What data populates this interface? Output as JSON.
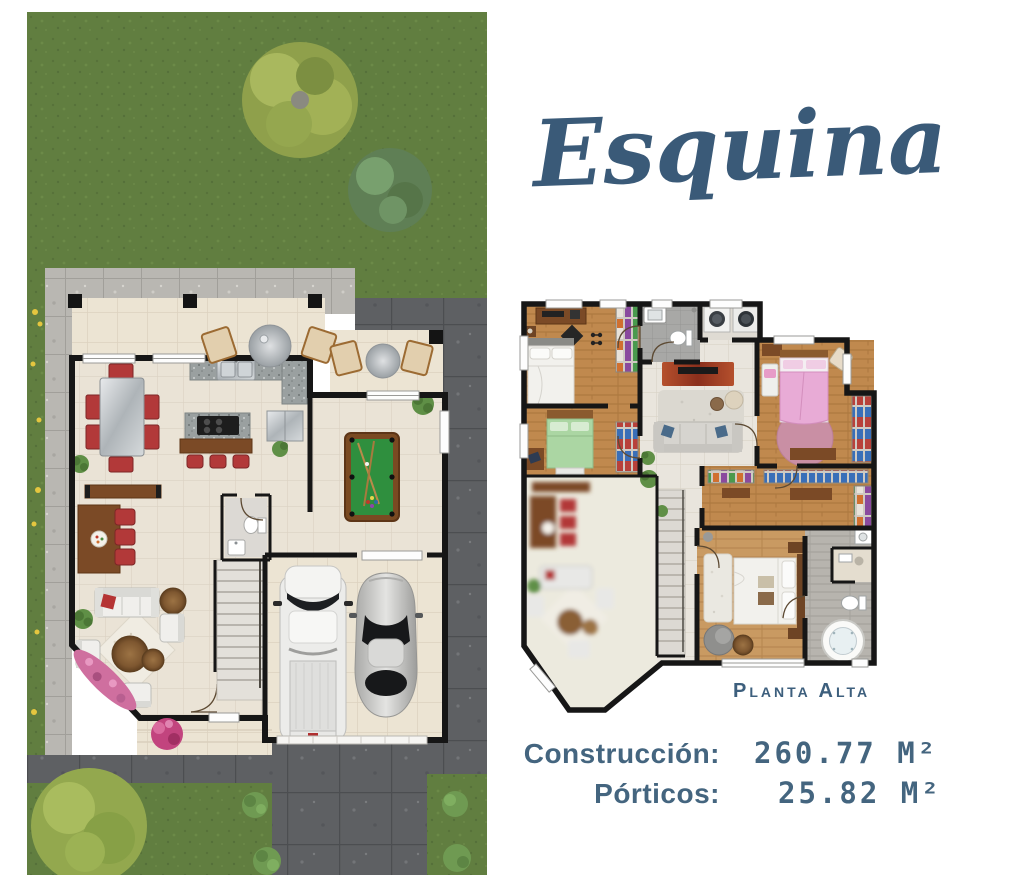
{
  "title": "Esquina",
  "plan_label": "Planta Alta",
  "stats": {
    "construction_label": "Construcción:",
    "construction_value": "260.77 M²",
    "porticos_label": "Pórticos:",
    "porticos_value": "25.82 M²"
  },
  "colors": {
    "accent": "#3a5a78",
    "stats": "#44657f",
    "wall": "#161616",
    "grass": "#617e40",
    "pave_light": "#b9b7b2",
    "pave_dark": "#5e6063",
    "floor": "#eae3d6",
    "terr": "#ece4d3",
    "wood": "#c0894e",
    "red": "#b23939",
    "pool": "#2f8f3e",
    "pinkbed": "#e8abd6",
    "greenbed": "#abd6a3",
    "rugrose": "#c98fa4",
    "flpink": "#cf6f9f",
    "flyellow": "#e5c63f"
  }
}
